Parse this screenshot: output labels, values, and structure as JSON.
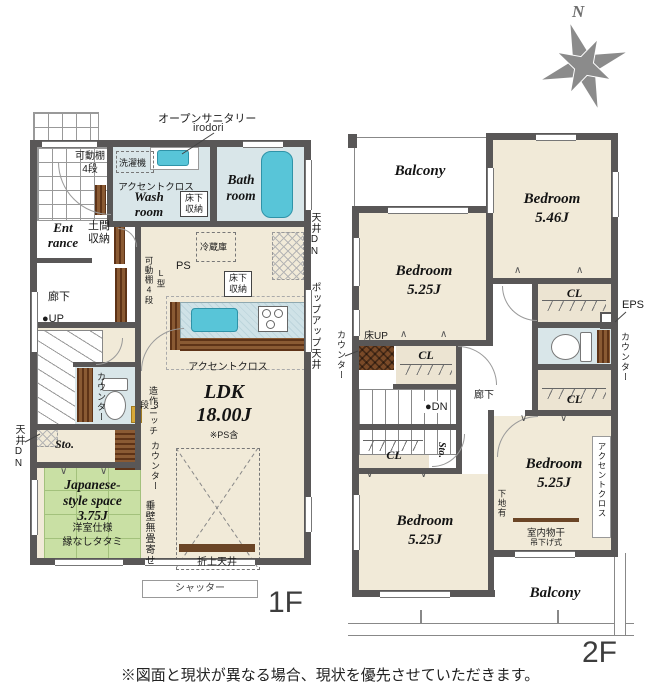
{
  "page": {
    "compass_n": "N",
    "disclaimer": "※図面と現状が異なる場合、現状を優先させていただきます。"
  },
  "icons": {
    "chevron_up": "∧",
    "chevron_down": "∨"
  },
  "f1": {
    "floor_label": "1F",
    "sanitary_note": "オープンサニタリー",
    "sanitary_note_sub": "irodori",
    "entrance_shelf": "可動棚\n4段",
    "washer": "洗濯機",
    "wash_accent": "アクセントクロス",
    "wash_room": "Wash\nroom",
    "wash_underfloor": "床下\n収納",
    "bath_room": "Bath\nroom",
    "entrance": "Ent\nrance",
    "entrance_storage": "土間\n収納",
    "hallway": "廊下",
    "up": "●UP",
    "fridge": "冷蔵庫",
    "ps": "PS",
    "kitchen_shelf": "可動棚4段",
    "kitchen_shelf_type": "L型",
    "kitchen_underfloor": "床下\n収納",
    "ceiling_dn_right": "天井DN",
    "popup_ceiling": "ポップアップ天井",
    "ldk_accent": "アクセントクロス",
    "ldk": "LDK\n18.00J",
    "ldk_note": "※PS含",
    "toilet_counter": "カウンター",
    "niche": "造作ニッチ",
    "niche_steps": "3段",
    "storage": "Sto.",
    "ceiling_dn_left": "天井DN",
    "ldk_counter": "カウンター",
    "japanese_room": "Japanese-\nstyle space\n3.75J",
    "japanese_note": "洋室仕様\n縁なしタタミ",
    "hanging_wall": "垂壁無畳寄せ",
    "coffered_ceiling": "折上天井",
    "shutter": "シャッター"
  },
  "f2": {
    "floor_label": "2F",
    "balcony_top": "Balcony",
    "bedroom_a": "Bedroom\n5.46J",
    "bedroom_b": "Bedroom\n5.25J",
    "bedroom_c": "Bedroom\n5.25J",
    "bedroom_d": "Bedroom\n5.25J",
    "floor_up": "床UP",
    "counter_left": "カウンター",
    "cl_center": "CL",
    "hallway": "廊下",
    "dn": "●DN",
    "cl_right_top": "CL",
    "eps": "EPS",
    "toilet_counter": "カウンター",
    "cl_right_bottom": "CL",
    "cl_left": "CL",
    "storage": "Sto.",
    "wall_backing": "下地有",
    "drying_rod": "室内物干",
    "drying_type": "吊下げ式",
    "accent_cloth": "アクセントクロス",
    "balcony_bottom": "Balcony"
  }
}
